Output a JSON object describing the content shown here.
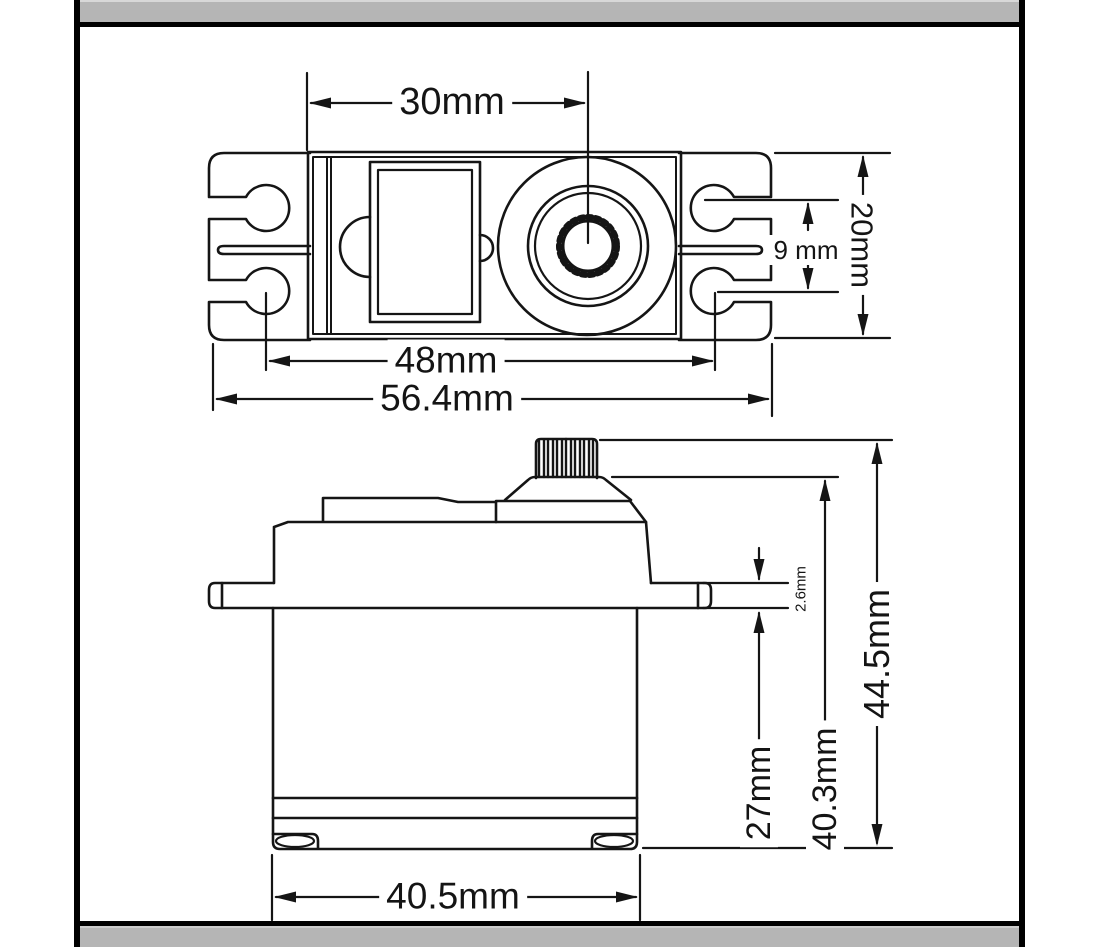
{
  "labels": {
    "top_view": {
      "case_to_shaft_width": "30mm",
      "slot_inner_span": "9 mm",
      "body_height": "20mm",
      "mount_hole_spacing": "48mm",
      "overall_width": "56.4mm"
    },
    "side_view": {
      "flange_thickness": "2.6mm",
      "body_below_flange": "27mm",
      "height_without_shaft": "40.3mm",
      "overall_height": "44.5mm",
      "lower_body_width": "40.5mm"
    }
  },
  "colors": {
    "line": "#151515",
    "background": "#ffffff",
    "frame_border": "#000000",
    "band_gray": "#b5b5b5",
    "band_highlight": "#d8d8d8"
  }
}
